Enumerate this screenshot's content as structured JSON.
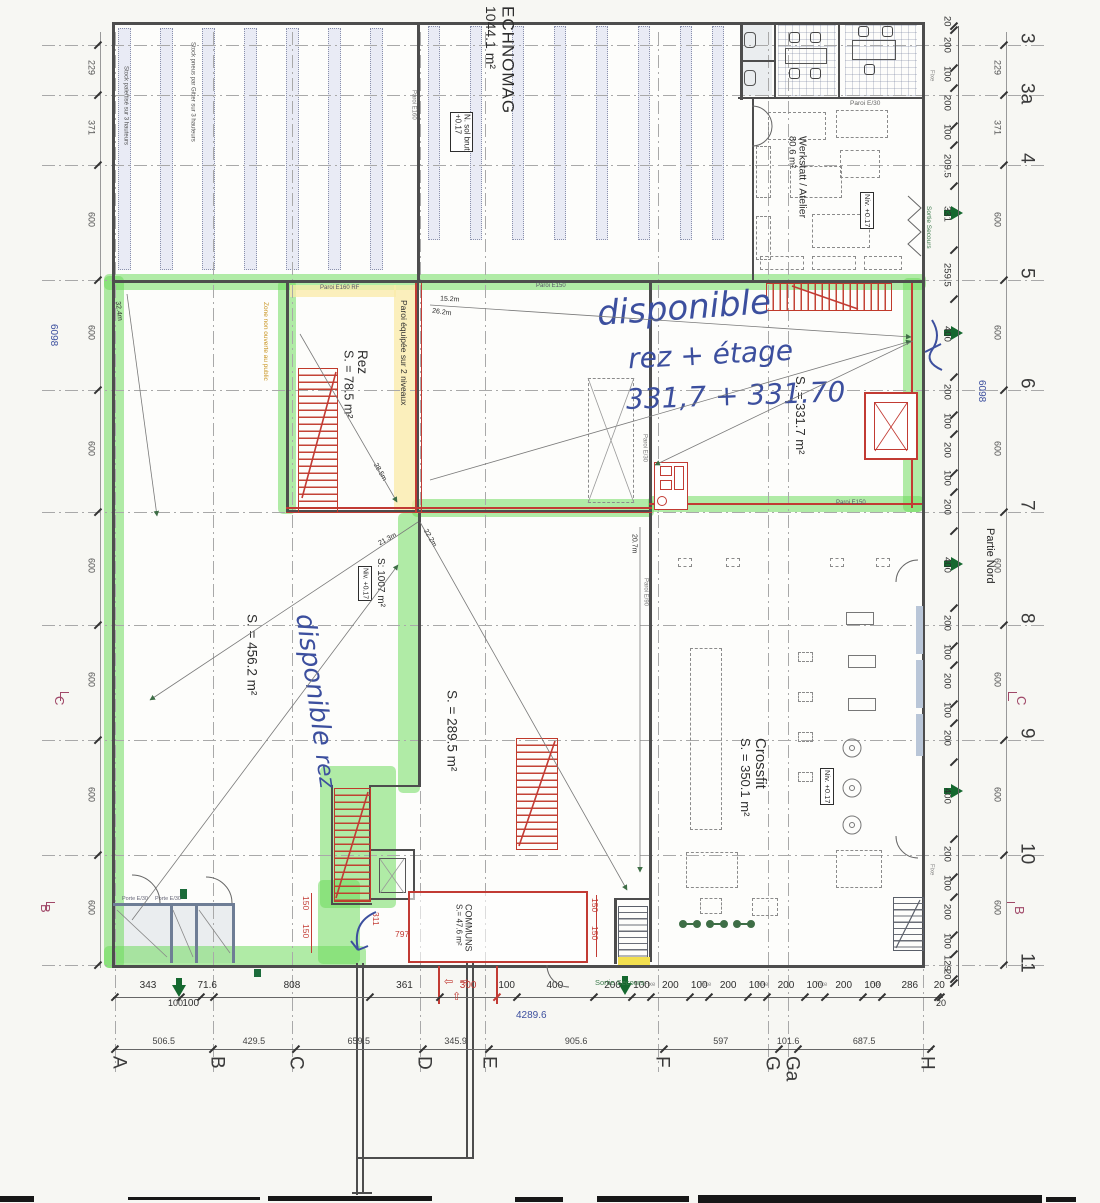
{
  "colors": {
    "highlight_green": "#69da58",
    "ink_blue": "#3c4f9e",
    "annotation_red": "#c23b34",
    "dim_maroon": "#a04868",
    "door_yellow": "#f2df4e"
  },
  "rooms": {
    "echnomag": {
      "name": "ECHNOMAG",
      "area": "1044.1 m²"
    },
    "werkstatt": {
      "name": "Werkstatt / Atelier",
      "area": "80.6 m²"
    },
    "rez": {
      "name": "Rez",
      "area": "S. = 78.5 m²"
    },
    "zone_331": {
      "area": "S. = 331.7 m²"
    },
    "zone_456": {
      "area": "S. = 456.2 m²"
    },
    "zone_1007": {
      "area": "S: 1007 m²"
    },
    "zone_289": {
      "area": "S. = 289.5 m²"
    },
    "crossfit": {
      "name": "Crossfit",
      "area": "S. = 350.1 m²"
    },
    "communs": {
      "name": "COMMUNS",
      "area": "S.= 47.6 m²"
    }
  },
  "annotations": {
    "hand_right": [
      "disponible",
      "rez + étage",
      "331,7 + 331.70"
    ],
    "hand_left": [
      "disponible",
      "rez"
    ]
  },
  "wall_labels": {
    "paroi_equipee": "Paroi équipée sur 2 niveaux",
    "paroi_e160rf": "Paroi E160 RF",
    "paroi_e160": "Paroi E160",
    "paroi_e150": "Paroi E150",
    "paroi_e90": "Paroi E/90",
    "paroi_e30": "Paroi E/30",
    "porte_e30": "Porte E/30",
    "n_sol_brut": "N. sol brut",
    "n_sol_brut_level": "+0.17",
    "niv": "Niv. +0.17",
    "stock_left": "Stock palettisé sur 3 hauteurs",
    "stock_mid": "Stock pneus par Gitter sur 3 hauteurs",
    "zone_non_ouverte": "Zone non ouverte au public",
    "sortie_secours": "Sortie Secours",
    "fixe": "Fixe",
    "partie_nord": "Partie Nord"
  },
  "measure_lines": {
    "d32": "32.4m",
    "d28": "28.5m",
    "d26": "26.2m",
    "d15": "15.2m",
    "d21": "21.3m",
    "d22": "22.2m",
    "d20": "20.7m"
  },
  "grid": {
    "letters": [
      "A",
      "B",
      "C",
      "D",
      "E",
      "F",
      "G",
      "Ga",
      "H"
    ],
    "numbers": [
      "3",
      "3a",
      "4",
      "5",
      "6",
      "7",
      "8",
      "9",
      "10",
      "11"
    ],
    "revision_marks": [
      "C",
      "B"
    ]
  },
  "dimensions": {
    "bottom_row1": [
      "343",
      "100",
      "71.6",
      "808",
      "361",
      "300",
      "100",
      "400",
      "200",
      "100",
      "200",
      "100",
      "200",
      "100",
      "200",
      "100",
      "200",
      "100",
      "286",
      "20"
    ],
    "bottom_row2": [
      "506.5",
      "429.5",
      "659.5",
      "345.9",
      "905.6",
      "597",
      "101.6",
      "687.5"
    ],
    "bottom_total": "4289.6",
    "right_chain": [
      "20",
      "200",
      "100",
      "200",
      "100",
      "209.5",
      "331",
      "259.5",
      "400",
      "200",
      "100",
      "200",
      "100",
      "200",
      "400",
      "200",
      "100",
      "200",
      "100",
      "200",
      "400",
      "200",
      "100",
      "200",
      "100",
      "129",
      "20"
    ],
    "outer_chain": [
      "229",
      "371",
      "600",
      "600",
      "600",
      "600",
      "600",
      "600",
      "600"
    ],
    "overall": "6098",
    "end_left": "100",
    "end_right": "20",
    "red_150": [
      "150",
      "150"
    ],
    "red_311": "311",
    "red_797": "797"
  }
}
